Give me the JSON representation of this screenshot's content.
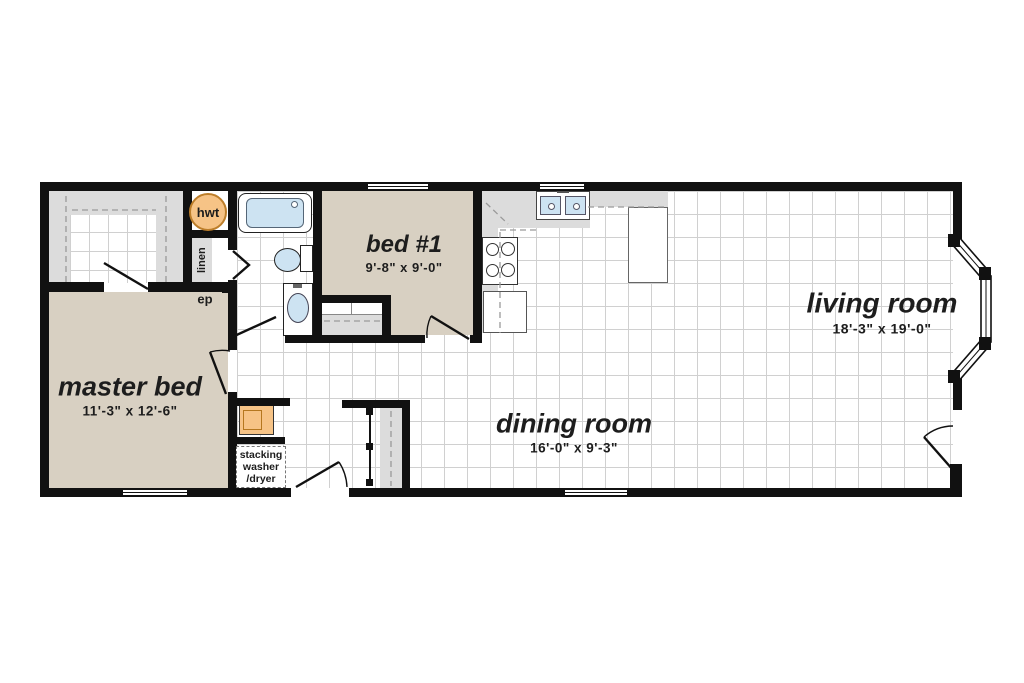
{
  "plan": {
    "rooms": [
      {
        "id": "master-bed",
        "name": "master bed",
        "dims": "11'-3\" x 12'-6\""
      },
      {
        "id": "bed-1",
        "name": "bed #1",
        "dims": "9'-8\" x 9'-0\""
      },
      {
        "id": "living-room",
        "name": "living room",
        "dims": "18'-3\" x 19'-0\""
      },
      {
        "id": "dining-room",
        "name": "dining room",
        "dims": "16'-0\" x 9'-3\""
      }
    ],
    "labels": {
      "hot_water_tank": "hwt",
      "linen_closet": "linen",
      "electrical_panel": "ep",
      "washer_dryer_lines": [
        "stacking",
        "washer",
        "/dryer"
      ]
    },
    "colors": {
      "wall": "#111111",
      "carpet_tan": "#d8d0c2",
      "cabinet_gray": "#dcdcdc",
      "fixture_blue": "#cde3f2",
      "appliance_orange": "#f6c386",
      "tile_line": "#d0d0d0"
    }
  }
}
